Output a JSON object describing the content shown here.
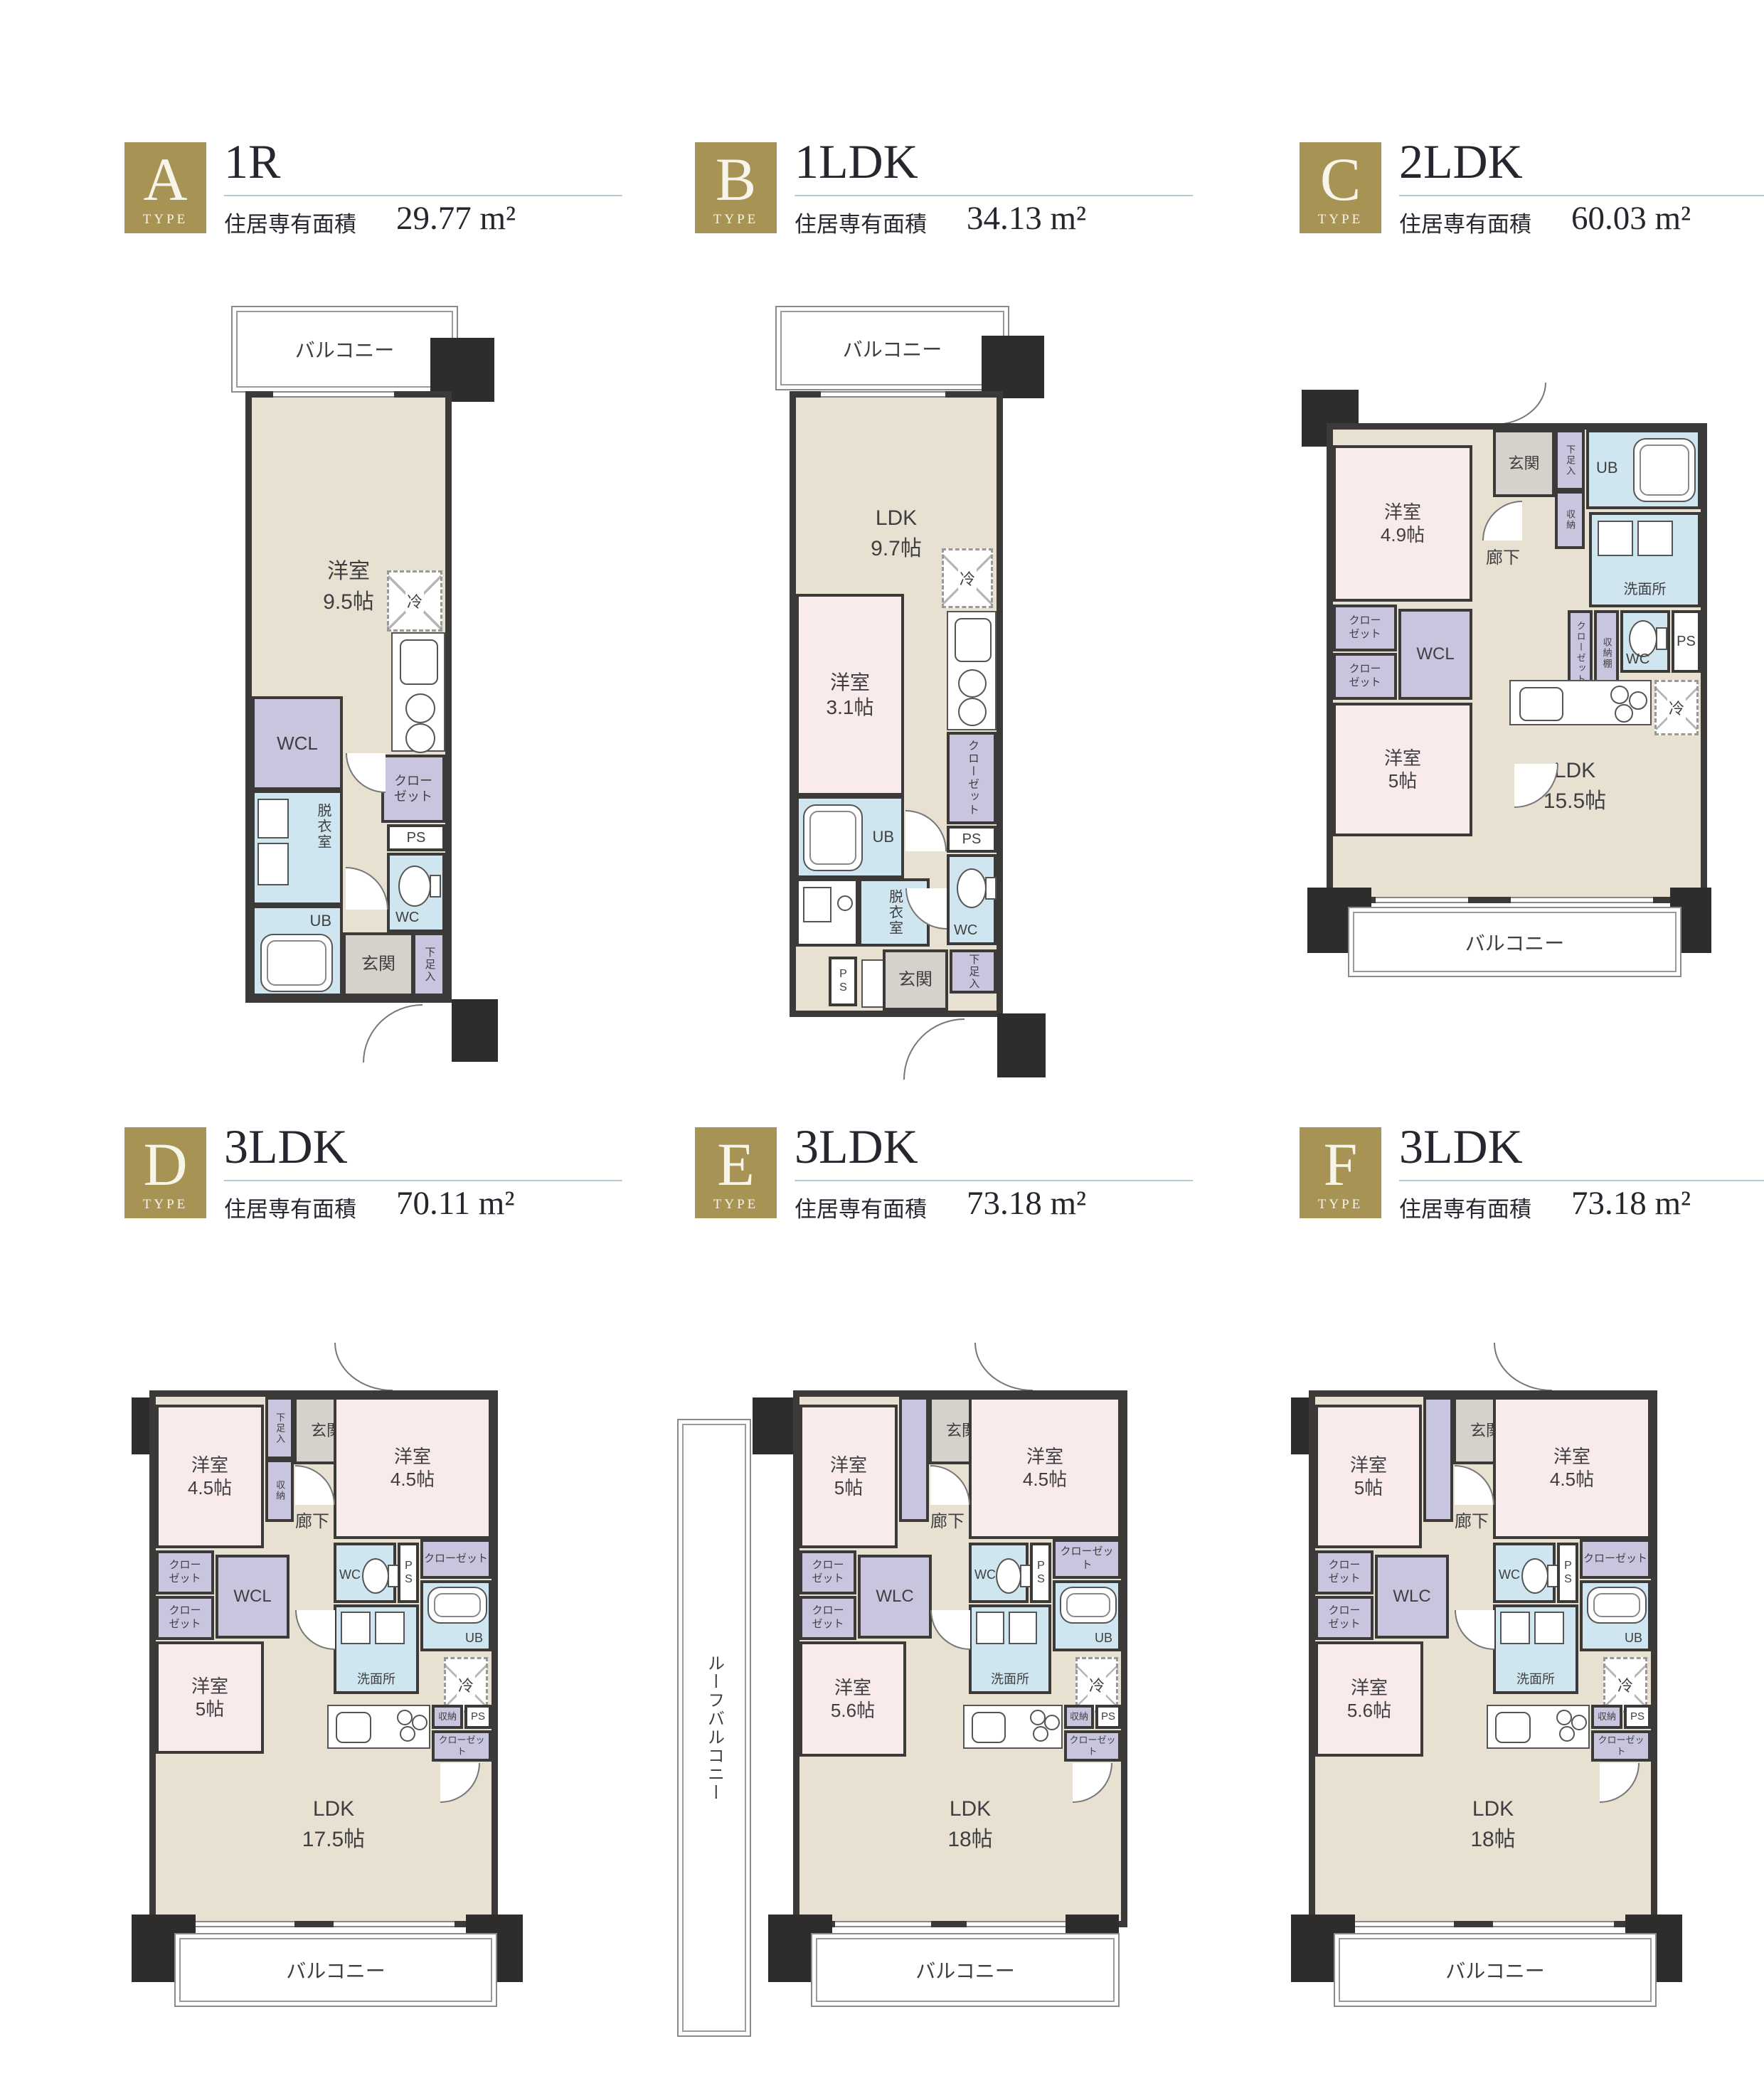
{
  "colors": {
    "gold": "#a79354",
    "wall": "#3b3a38",
    "beige": "#e8e1d2",
    "pink": "#f9eaeb",
    "lavender": "#c9c5de",
    "water_blue": "#cfe5ef",
    "entry_gray": "#d5d2cb",
    "rule_line": "#b9c9d3",
    "text": "#3f3f42"
  },
  "plans": {
    "A": {
      "letter": "A",
      "type_caption": "TYPE",
      "layout": "1R",
      "area_caption": "住居専有面積",
      "area": "29.77 m²",
      "rooms": {
        "balcony": "バルコニー",
        "main": "洋室",
        "main_size": "9.5帖",
        "wcl": "WCL",
        "datsui": "脱衣室",
        "ub": "UB",
        "closet": "クローゼット",
        "ps": "PS",
        "wc": "WC",
        "genkan": "玄関",
        "geta": "下足入",
        "rei": "冷"
      }
    },
    "B": {
      "letter": "B",
      "type_caption": "TYPE",
      "layout": "1LDK",
      "area_caption": "住居専有面積",
      "area": "34.13 m²",
      "rooms": {
        "balcony": "バルコニー",
        "ldk": "LDK",
        "ldk_size": "9.7帖",
        "room": "洋室",
        "room_size": "3.1帖",
        "ub": "UB",
        "datsui": "脱衣室",
        "closet": "クローゼット",
        "ps": "PS",
        "ps2": "PS",
        "wc": "WC",
        "genkan": "玄関",
        "geta": "下足入",
        "rei": "冷"
      }
    },
    "C": {
      "letter": "C",
      "type_caption": "TYPE",
      "layout": "2LDK",
      "area_caption": "住居専有面積",
      "area": "60.03 m²",
      "rooms": {
        "genkan": "玄関",
        "geta": "下足入",
        "shuno": "収納",
        "ub": "UB",
        "senmen": "洗面所",
        "room1": "洋室",
        "room1_size": "4.9帖",
        "rouka": "廊下",
        "closet1": "クローゼット",
        "closet2": "クローゼット",
        "wcl": "WCL",
        "closet3": "クローゼット",
        "shunodana": "収納棚",
        "wc": "WC",
        "ps": "PS",
        "rei": "冷",
        "room2": "洋室",
        "room2_size": "5帖",
        "ldk": "LDK",
        "ldk_size": "15.5帖",
        "balcony": "バルコニー"
      }
    },
    "D": {
      "letter": "D",
      "type_caption": "TYPE",
      "layout": "3LDK",
      "area_caption": "住居専有面積",
      "area": "70.11 m²",
      "rooms": {
        "geta": "下足入",
        "shuno": "収納",
        "genkan": "玄関",
        "room1": "洋室",
        "room1_size": "4.5帖",
        "room2": "洋室",
        "room2_size": "4.5帖",
        "rouka": "廊下",
        "wc": "WC",
        "ps": "PS",
        "closet_r": "クローゼット",
        "closet1": "クローゼット",
        "closet2": "クローゼット",
        "wcl": "WCL",
        "senmen": "洗面所",
        "ub": "UB",
        "rei": "冷",
        "room3": "洋室",
        "room3_size": "5帖",
        "ldk": "LDK",
        "ldk_size": "17.5帖",
        "shuno2": "収納",
        "ps2": "PS",
        "closet3": "クローゼット",
        "balcony": "バルコニー"
      }
    },
    "E": {
      "letter": "E",
      "type_caption": "TYPE",
      "layout": "3LDK",
      "area_caption": "住居専有面積",
      "area": "73.18 m²",
      "rooms": {
        "roof_balcony": "ルーフバルコニー",
        "genkan": "玄関",
        "room1": "洋室",
        "room1_size": "5帖",
        "room2": "洋室",
        "room2_size": "4.5帖",
        "rouka": "廊下",
        "wc": "WC",
        "ps": "PS",
        "closet_r": "クローゼット",
        "closet1": "クローゼット",
        "closet2": "クローゼット",
        "wlc": "WLC",
        "senmen": "洗面所",
        "ub": "UB",
        "rei": "冷",
        "room3": "洋室",
        "room3_size": "5.6帖",
        "ldk": "LDK",
        "ldk_size": "18帖",
        "shuno2": "収納",
        "ps2": "PS",
        "closet3": "クローゼット",
        "balcony": "バルコニー"
      }
    },
    "F": {
      "letter": "F",
      "type_caption": "TYPE",
      "layout": "3LDK",
      "area_caption": "住居専有面積",
      "area": "73.18 m²",
      "rooms": {
        "genkan": "玄関",
        "room1": "洋室",
        "room1_size": "5帖",
        "room2": "洋室",
        "room2_size": "4.5帖",
        "rouka": "廊下",
        "wc": "WC",
        "ps": "PS",
        "closet_r": "クローゼット",
        "closet1": "クローゼット",
        "closet2": "クローゼット",
        "wlc": "WLC",
        "senmen": "洗面所",
        "ub": "UB",
        "rei": "冷",
        "room3": "洋室",
        "room3_size": "5.6帖",
        "ldk": "LDK",
        "ldk_size": "18帖",
        "shuno2": "収納",
        "ps2": "PS",
        "closet3": "クローゼット",
        "balcony": "バルコニー"
      }
    }
  }
}
